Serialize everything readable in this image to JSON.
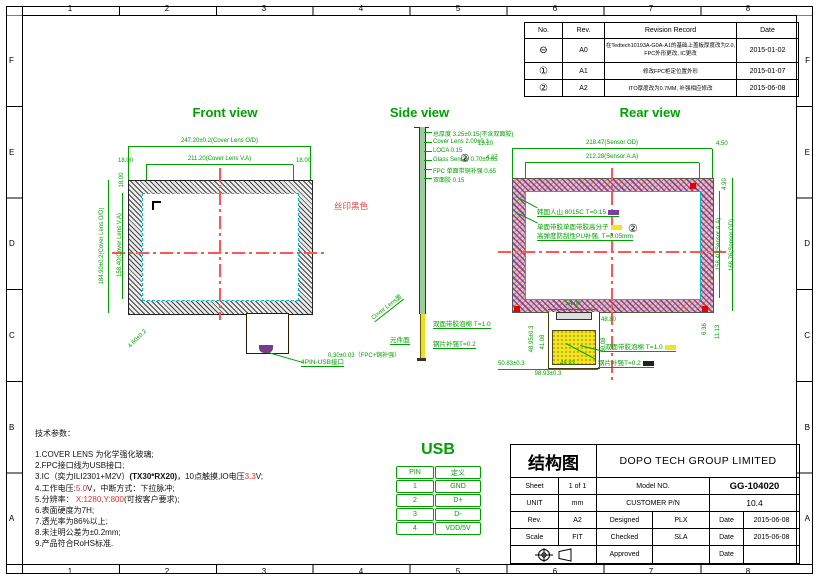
{
  "frame": {
    "cols": [
      "1",
      "2",
      "3",
      "4",
      "5",
      "6",
      "7",
      "8"
    ],
    "rows": [
      "F",
      "E",
      "D",
      "C",
      "B",
      "A"
    ]
  },
  "revision_table": {
    "headers": {
      "no": "No.",
      "rev": "Rev.",
      "record": "Revision Record",
      "date": "Date"
    },
    "rows": [
      {
        "no": "⊖",
        "rev": "A0",
        "record": "在Tedtech10193A-G0A-A1的基础上盖板厚度改为2.0, FPC外形更改, IC更改",
        "date": "2015-01-02"
      },
      {
        "no": "①",
        "rev": "A1",
        "record": "修改FPC柜定位置外形",
        "date": "2015-01-07"
      },
      {
        "no": "②",
        "rev": "A2",
        "record": "ITO厚度改为0.7MM, 补强相应修改",
        "date": "2015-06-08"
      }
    ]
  },
  "front_view": {
    "title": "Front view",
    "dims": {
      "od_w": "247.20±0.2(Cover Lens O/D)",
      "va_w": "211.20(Cover Lens V.A)",
      "margin_left": "18.00",
      "margin_right": "18.00",
      "margin_top": "18.00",
      "od_h": "184.90±0.2(Cover Lens O/D)",
      "va_h": "158.40(Cover Lens V.A)",
      "corner": "4.60±0.2"
    },
    "silk_label": "丝印黑色",
    "connector_label": "4PIN-USB接口"
  },
  "side_view": {
    "title": "Side view",
    "layers": [
      "总厚度 3.25±0.15(不含双面胶)",
      "Cover Lens 2.00±0.1",
      "LOCA 0.15",
      "Glass Sensor 0.70±0.05",
      "FPC 单面带铜补强 0.65",
      "双面胶 0.15"
    ],
    "callout": "②",
    "foam_label": "双面带胶泡棉 T=1.0",
    "steel_label": "钢片补强T=0.2",
    "component_side": "元件面",
    "fpc_thickness": "0.30±0.03（FPC+铜补强）",
    "face_label": "Cover Lens面"
  },
  "rear_view": {
    "title": "Rear view",
    "dims": {
      "sensor_od_w": "218.47(Sensor OD)",
      "sensor_aa_w": "212.28(Sensor A.A)",
      "left1": "13.20",
      "left2": "4.27",
      "right1": "4.50",
      "right2": "4.90",
      "sensor_aa_h": "158.40(Sensor A.A)",
      "sensor_od_h": "168.76(Sensor OD)",
      "br1": "6.36",
      "br2": "11.13",
      "tab_w": "54.00",
      "tab_w2": "48.80",
      "tab_l1": "48.95±0.3",
      "tab_l2": "41.08",
      "tab_r": "50.08",
      "tab_b1": "50.83±0.3",
      "tab_b2": "48.83",
      "tab_b3": "98.93±0.3"
    },
    "labels": {
      "tape": "韩国人山 8015C T=0.15",
      "adhesive": "单面带胶单面带胶高分子",
      "pu": "高弹度防刮性PU补强, T=0.05mm",
      "callout": "②",
      "foam": "双面带胶泡棉 T=1.0",
      "steel": "钢片补强T=0.2"
    }
  },
  "notes": {
    "heading": "技术参数：",
    "line1": "1.COVER LENS 为化学强化玻璃;",
    "line2": "2.FPC接口线为USB接口;",
    "line3a": "3.IC（奕力ILI2301+M2V）",
    "line3b": "(TX30*RX20)",
    "line3c": "，10点触摸,IO电压",
    "line3d": "3.3",
    "line3e": "V;",
    "line4a": "4.工作电压:",
    "line4b": "5.0",
    "line4c": "V，中断方式：下拉脉冲;",
    "line5a": "5.分辨率： ",
    "line5b": "X:1280,Y:800",
    "line5c": "(可按客户要求);",
    "line6": "6.表面硬度为7H;",
    "line7": "7.透光率为86%以上;",
    "line8": "8.未注明公差为±0.2mm;",
    "line9": "9.产品符合RoHS标准."
  },
  "usb_table": {
    "title": "USB",
    "headers": {
      "pin": "PIN",
      "def": "定义"
    },
    "rows": [
      {
        "pin": "1",
        "def": "GND"
      },
      {
        "pin": "2",
        "def": "D+"
      },
      {
        "pin": "3",
        "def": "D-"
      },
      {
        "pin": "4",
        "def": "VDD/5V"
      }
    ]
  },
  "title_block": {
    "doc_type": "结构图",
    "company": "DOPO TECH GROUP LIMITED",
    "sheet_label": "Sheet",
    "sheet_value": "1 of 1",
    "model_label": "Model NO.",
    "model_value": "GG-104020",
    "unit_label": "UNIT",
    "unit_value": "mm",
    "pn_label": "CUSTOMER P/N",
    "pn_value": "10.4",
    "rev_label": "Rev.",
    "rev_value": "A2",
    "designed_label": "Designed",
    "designed_value": "PLX",
    "date_label1": "Date",
    "date_value1": "2015-06-08",
    "scale_label": "Scale",
    "scale_value": "FIT",
    "checked_label": "Checked",
    "checked_value": "SLA",
    "date_label2": "Date",
    "date_value2": "2015-06-08",
    "approved_label": "Approved",
    "date_label3": "Date"
  },
  "colors": {
    "dim_green": "#00a000",
    "center_red": "#f55555",
    "cyan": "#00b8c8",
    "fpc_yellow": "#f2e41e",
    "tape_purple": "#7a3fa0"
  }
}
